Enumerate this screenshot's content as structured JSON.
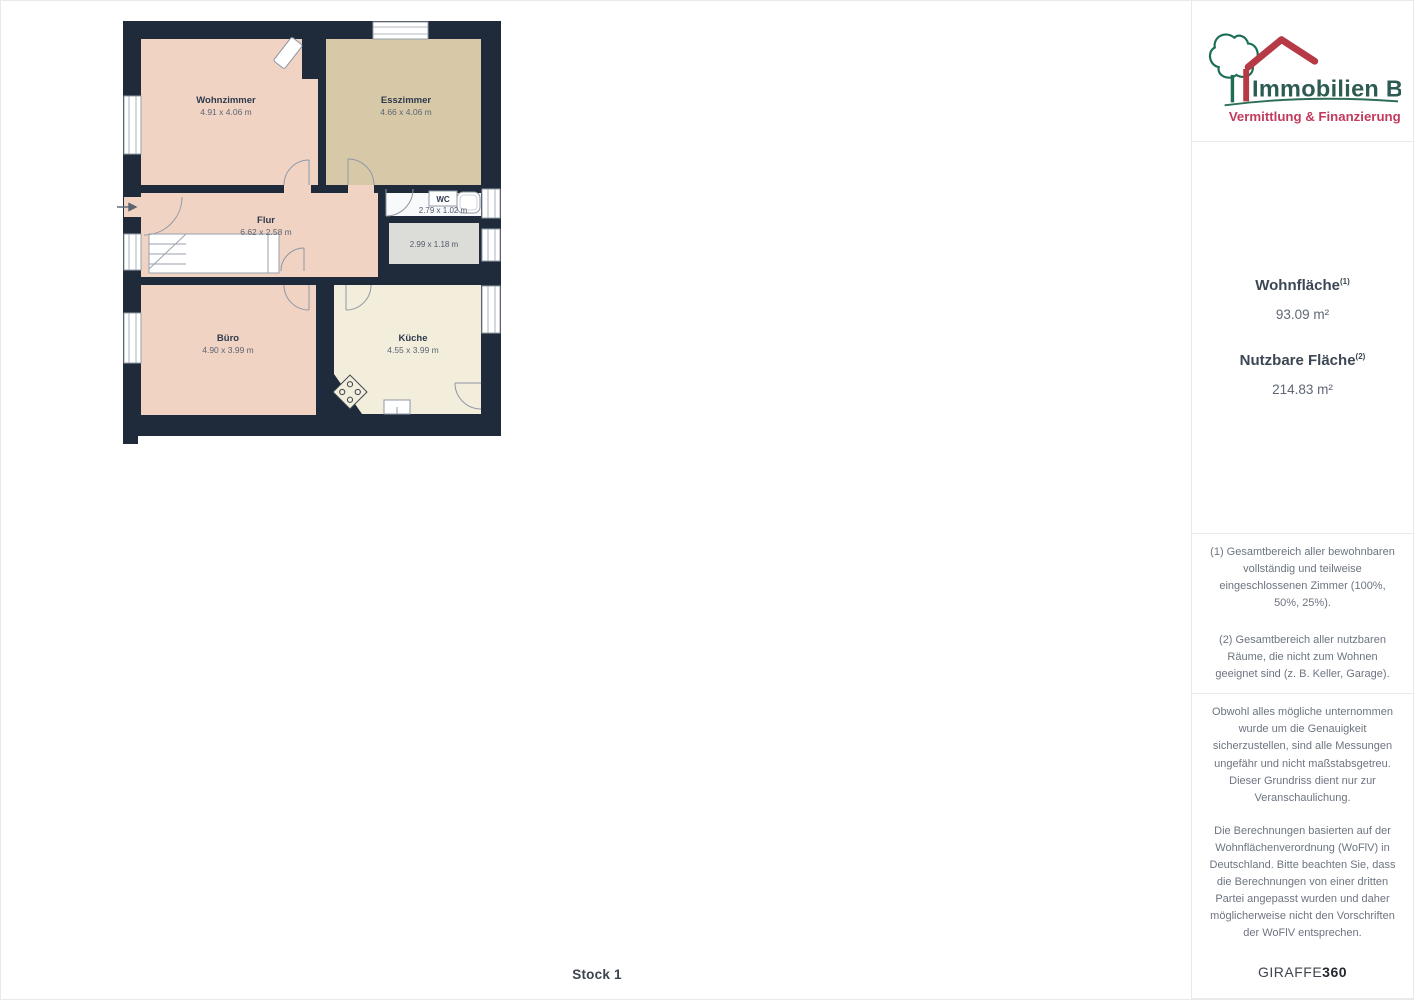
{
  "page": {
    "floor_label": "Stock 1"
  },
  "floorplan": {
    "rooms": {
      "wohnzimmer": {
        "name": "Wohnzimmer",
        "dims": "4.91 x 4.06 m"
      },
      "esszimmer": {
        "name": "Esszimmer",
        "dims": "4.66 x 4.06 m"
      },
      "flur": {
        "name": "Flur",
        "dims": "6.62 x 2.58 m"
      },
      "wc": {
        "name": "WC",
        "dims": "2.79 x 1.02 m"
      },
      "abstellraum": {
        "name": "",
        "dims": "2.99 x 1.18 m"
      },
      "buero": {
        "name": "Büro",
        "dims": "4.90 x 3.99 m"
      },
      "kueche": {
        "name": "Küche",
        "dims": "4.55 x 3.99 m"
      }
    },
    "colors": {
      "wall": "#1f2a3a",
      "room_warm": "#f1d3c3",
      "room_tan": "#d7c9a7",
      "room_cream": "#f3eddb",
      "room_wc": "#f7f9fa",
      "room_gray": "#dcdcd8"
    }
  },
  "sidebar": {
    "logo": {
      "title": "Immobilien Bart",
      "subtitle": "Vermittlung & Finanzierung",
      "title_color": "#2d5b52",
      "subtitle_color": "#c23a5c"
    },
    "areas": {
      "wohnflaeche": {
        "label": "Wohnfläche",
        "footnote_ref": "(1)",
        "value": "93.09 m²"
      },
      "nutzflaeche": {
        "label": "Nutzbare Fläche",
        "footnote_ref": "(2)",
        "value": "214.83 m²"
      }
    },
    "footnotes": {
      "note1": "(1) Gesamtbereich aller bewohnbaren vollständig und teilweise eingeschlossenen Zimmer (100%, 50%, 25%).",
      "note2": "(2) Gesamtbereich aller nutzbaren Räume, die nicht zum Wohnen geeignet sind (z. B. Keller, Garage)."
    },
    "disclaimer": {
      "para1": "Obwohl alles mögliche unternommen wurde um die Genauigkeit sicherzustellen, sind alle Messungen ungefähr und nicht maßstabsgetreu. Dieser Grundriss dient nur zur Veranschaulichung.",
      "para2": "Die Berechnungen basierten auf der Wohnflächenverordnung (WoFlV) in Deutschland. Bitte beachten Sie, dass die Berechnungen von einer dritten Partei angepasst wurden und daher möglicherweise nicht den Vorschriften der WoFlV entsprechen.",
      "brand_name": "GIRAFFE",
      "brand_suffix": "360"
    }
  }
}
